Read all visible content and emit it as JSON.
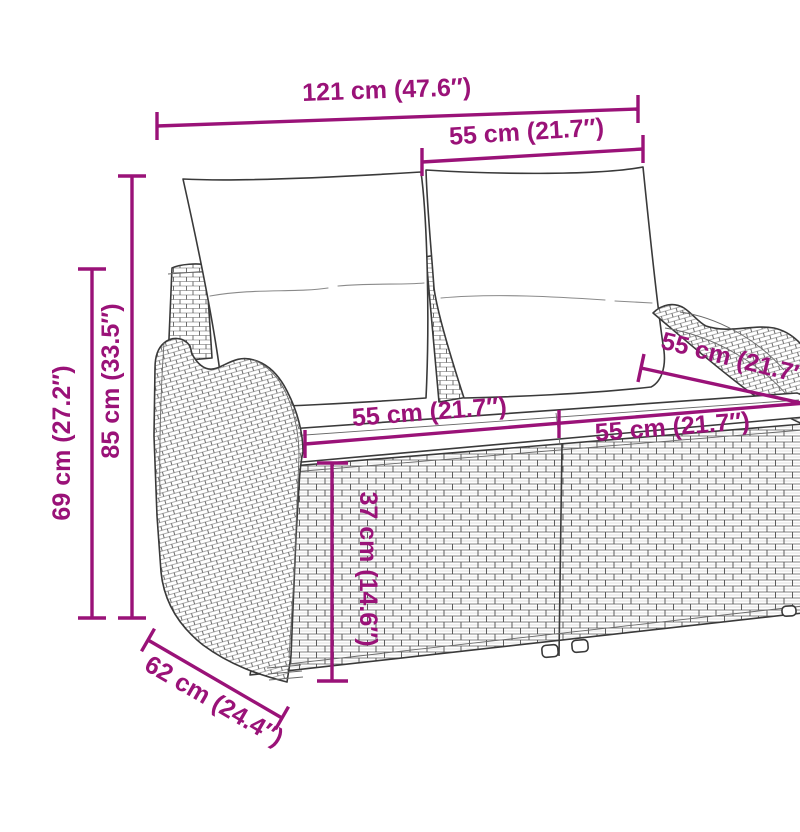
{
  "figure": {
    "subject": "Poly rattan two-seater garden bench with back and seat cushions — dimension line drawing"
  },
  "colors": {
    "dimension_accent": "#9A1278",
    "line_art": "#3a3a3a",
    "background": "#ffffff"
  },
  "dims": [
    {
      "id": "width-total",
      "label": "121 cm (47.6″)"
    },
    {
      "id": "width-seat-top",
      "label": "55 cm (21.7″)"
    },
    {
      "id": "height-total",
      "label": "85 cm (33.5″)"
    },
    {
      "id": "height-secondary",
      "label": "69 cm (27.2″)"
    },
    {
      "id": "seat-width-left",
      "label": "55 cm (21.7″)"
    },
    {
      "id": "seat-width-right",
      "label": "55 cm (21.7″)"
    },
    {
      "id": "seat-depth",
      "label": "55 cm (21.7″)"
    },
    {
      "id": "seat-height",
      "label": "37 cm (14.6″)"
    },
    {
      "id": "depth-total",
      "label": "62 cm (24.4″)"
    }
  ]
}
